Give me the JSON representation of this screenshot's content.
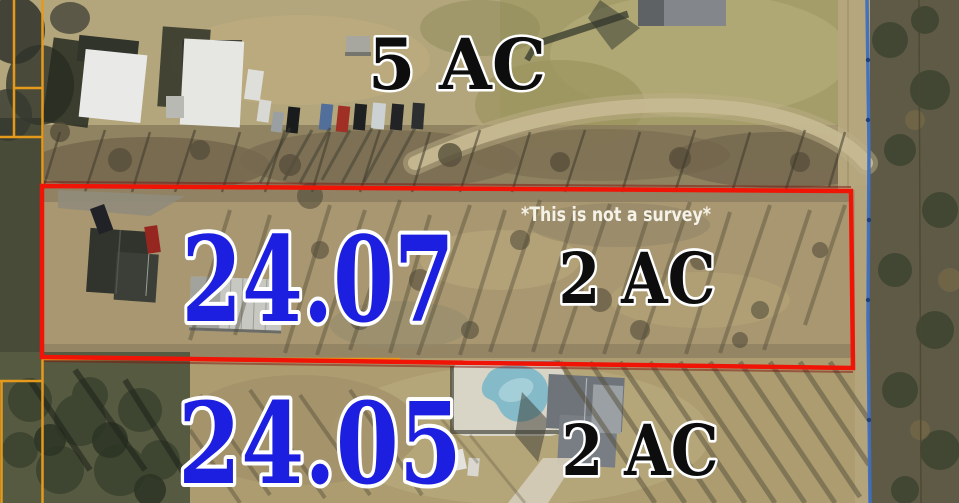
{
  "map": {
    "labels": {
      "top_parcel_acreage": "5 AC",
      "highlight_parcel_number": "24.07",
      "highlight_parcel_acreage": "2 AC",
      "disclaimer": "*This is not a survey*",
      "bottom_parcel_number": "24.05",
      "bottom_parcel_acreage": "2 AC"
    },
    "colors": {
      "parcel_number_text": "#1c1ee0",
      "acreage_text": "#0d0d0d",
      "text_outline": "#ffffff",
      "highlight_boundary": "#f01406",
      "parcel_line": "#e59a1c",
      "utility_line": "#3e6fc0",
      "disclaimer_text": "#f5f2e8"
    }
  }
}
